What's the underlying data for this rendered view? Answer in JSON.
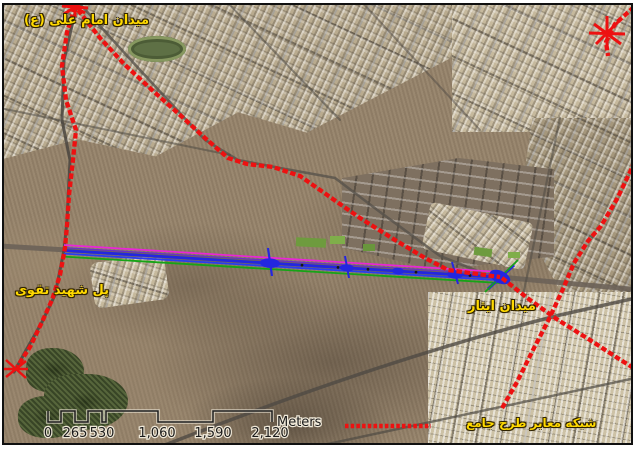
{
  "figure": {
    "type": "satellite-map-with-gis-overlay",
    "labels": {
      "imam_ali_square": "میدان امام علی (ع)",
      "shahid_taghavi_bridge": "پل شهید تقوی",
      "isar_square": "میدان ایثار"
    },
    "legend": {
      "symbol": "red-dashed-line",
      "label": "شبکه معابر طرح جامع",
      "color": "#ed1111"
    },
    "scalebar": {
      "unit": "Meters",
      "ticks": [
        "0",
        "265",
        "530",
        "1,060",
        "1,590",
        "2,120"
      ]
    },
    "colors": {
      "master_plan_network": "#ed1111",
      "corridor_blue": "#2326e0",
      "corridor_magenta": "#ea25d8",
      "corridor_green": "#16a416",
      "label_text": "#ffd900"
    }
  }
}
